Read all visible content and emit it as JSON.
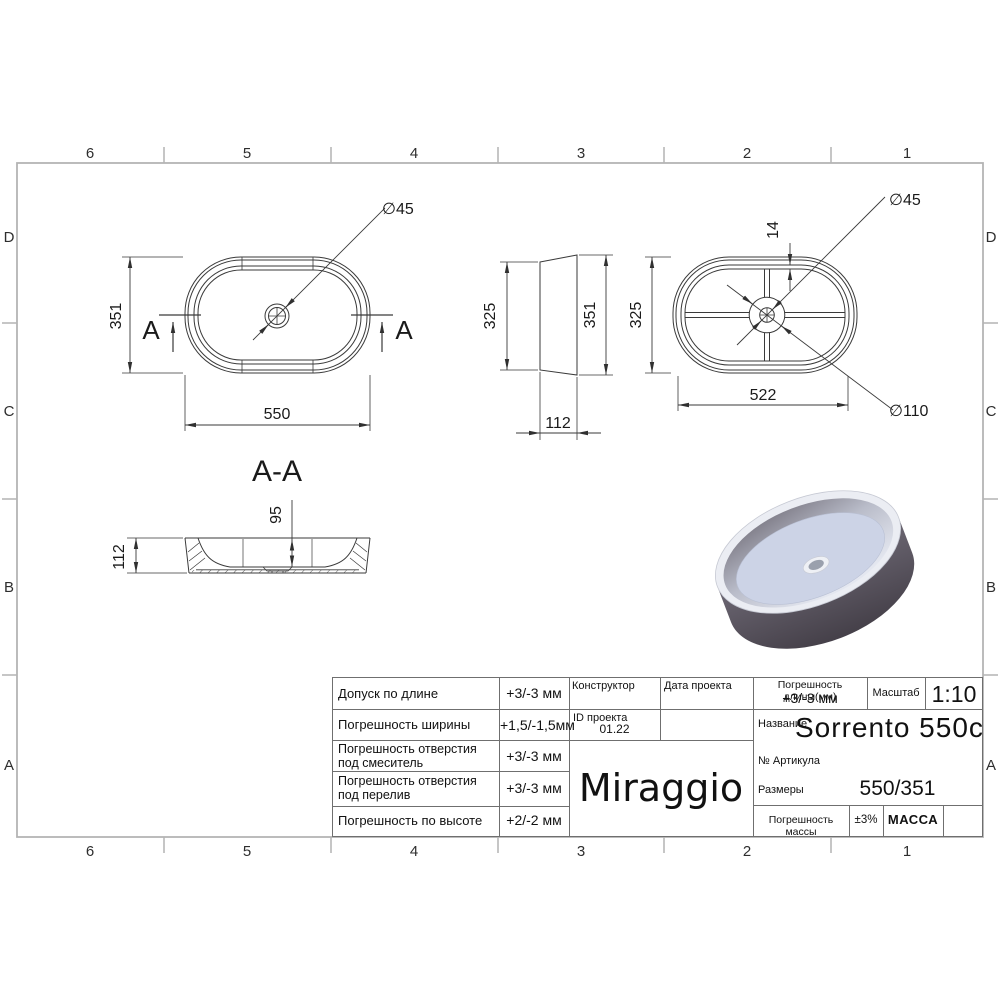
{
  "frame": {
    "cols": [
      "6",
      "5",
      "4",
      "3",
      "2",
      "1"
    ],
    "rows": [
      "D",
      "C",
      "B",
      "A"
    ]
  },
  "views": {
    "plan": {
      "width": "351",
      "length": "550",
      "drain_dia": "∅45",
      "section": "A"
    },
    "side": {
      "bottom_width": "325",
      "top_width": "351",
      "height": "112"
    },
    "bottom": {
      "width": "325",
      "base_length": "522",
      "rib": "14",
      "drain_dia": "∅45",
      "boss_dia": "∅110"
    },
    "section": {
      "label": "A-A",
      "height": "112",
      "depth": "95"
    }
  },
  "title_block": {
    "tolerances": [
      {
        "label": "Допуск по длине",
        "value": "+3/-3 мм"
      },
      {
        "label": "Погрешность ширины",
        "value": "+1,5/-1,5мм"
      },
      {
        "label": "Погрешность отверстия под смеситель",
        "value": "+3/-3 мм"
      },
      {
        "label": "Погрешность отверстия под перелив",
        "value": "+3/-3 мм"
      },
      {
        "label": "Погрешность по высоте",
        "value": "+2/-2 мм"
      }
    ],
    "constructor_label": "Конструктор",
    "project_date_label": "Дата проекта",
    "project_id_label": "ID проекта",
    "project_id_value": "01.22",
    "logo": "Miraggio",
    "length_tolerance_label": "Погрешность длины(мм)",
    "length_tolerance_value": "+3/-3 мм",
    "scale_label": "Масштаб",
    "scale_value": "1:10",
    "name_label": "Название",
    "name_value": "Sorrento 550c",
    "article_label": "№ Артикула",
    "sizes_label": "Размеры",
    "sizes_value": "550/351",
    "mass_tolerance_label": "Погрешность массы",
    "mass_tolerance_value": "±3%",
    "mass_label": "МАССА"
  },
  "colors": {
    "drawing_line": "#3a3a3a",
    "frame_line": "#b4b4b4",
    "table_line": "#6f6f6f",
    "render_body": "#514c5a",
    "render_basin": "#ccd3e6"
  }
}
